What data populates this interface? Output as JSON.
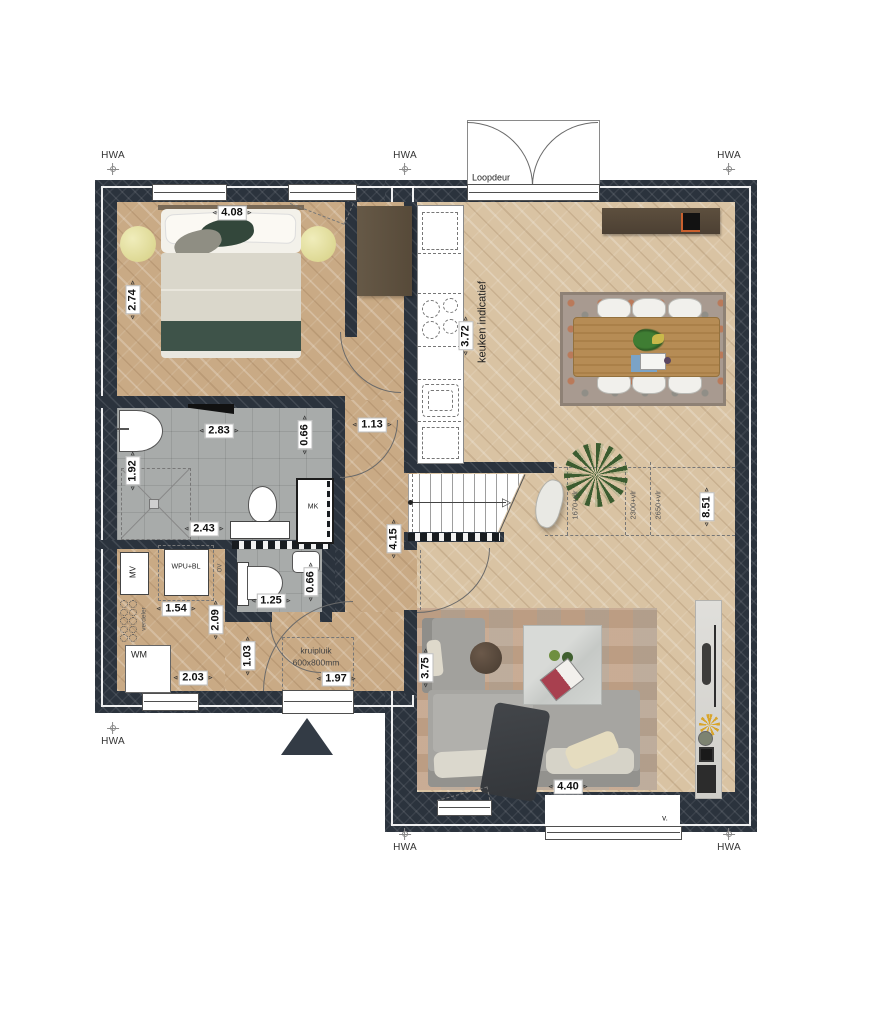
{
  "drawing": {
    "type": "residential floor plan",
    "annotations": {
      "hwa": "HWA",
      "loopdeur": "Loopdeur",
      "kitchen_note": "keuken indicatief",
      "meter_cupboard": "MK",
      "mechanical_ventilation": "MV",
      "heat_pump": "WPU+BL",
      "ov": "OV",
      "manifold": "verdeler",
      "washing_machine": "WM",
      "crawl_hatch": "kruipluik",
      "crawl_hatch_size": "600x800mm",
      "vent": "v.",
      "headroom_lines": [
        "1670+vlr",
        "2300+vlr",
        "2650+vlr"
      ]
    },
    "dimensions": {
      "bedroom_width": "4.08",
      "bedroom_depth": "2.74",
      "bathroom_width": "2.83",
      "bathroom_depth": "1.92",
      "bathroom_width_bottom": "2.43",
      "bathroom_door": "0.66",
      "hall_width": "1.13",
      "hall_length": "4.15",
      "wc_width": "1.25",
      "wc_door": "0.66",
      "utility_width": "1.54",
      "utility_depth": "2.09",
      "utility_width_bottom": "2.03",
      "corridor_depth": "1.03",
      "entry_width": "1.97",
      "kitchen_length": "3.72",
      "living_depth": "8.51",
      "living_width": "3.75",
      "sofa_zone_width": "4.40"
    },
    "colors": {
      "wall": "#2b333d",
      "wood_dark": "#c9aa85",
      "wood_light": "#d9c3a3",
      "tile": "#a8abaa",
      "accent_orange": "#c9602e"
    }
  }
}
